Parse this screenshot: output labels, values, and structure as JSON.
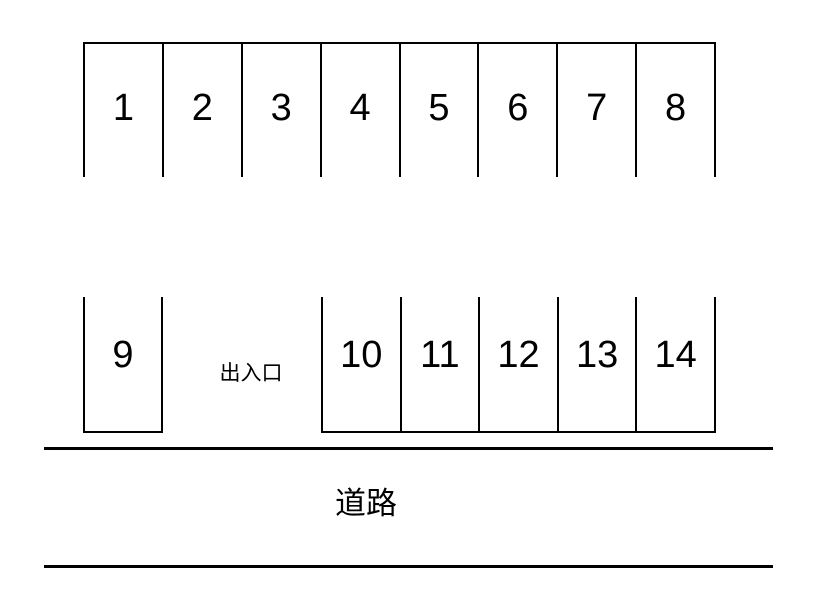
{
  "diagram": {
    "title": "parking-lot-layout",
    "colors": {
      "background": "#ffffff",
      "line": "#000000",
      "text": "#000000"
    },
    "top_row_spaces": [
      "1",
      "2",
      "3",
      "4",
      "5",
      "6",
      "7",
      "8"
    ],
    "bottom_left_space": "9",
    "entrance_label": "出入口",
    "bottom_right_spaces": [
      "10",
      "11",
      "12",
      "13",
      "14"
    ],
    "road_label": "道路"
  }
}
